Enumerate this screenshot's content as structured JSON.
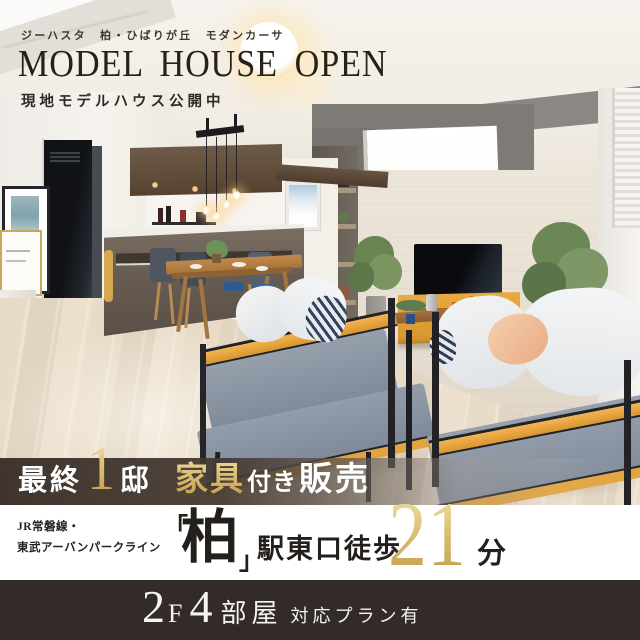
{
  "header": {
    "subtitle": "ジーハスタ　柏・ひばりが丘　モダンカーサ",
    "title": "MODEL HOUSE OPEN",
    "tagline": "現地モデルハウス公開中"
  },
  "sale_banner": {
    "prefix": "最終",
    "count": "1",
    "count_unit": "邸",
    "highlight": "家具",
    "middle": "付き",
    "suffix": "販売"
  },
  "access": {
    "rail_line1": "JR常磐線・",
    "rail_line2": "東武アーバンパークライン",
    "bracket_open": "「",
    "station": "柏",
    "bracket_close": "」",
    "walk": "駅東口徒歩",
    "minutes": "21",
    "minutes_unit": "分"
  },
  "footer": {
    "floor_number": "2",
    "floor_unit": "F",
    "room_number": "4",
    "room_unit": "部屋",
    "note": "対応プラン有"
  },
  "colors": {
    "gold": "#d9bd72",
    "sale_banner_bg": "#3f352d",
    "footer_bg": "#332b27",
    "access_bg": "#ffffff",
    "sofa_wood_accent": "#e2a33c"
  }
}
